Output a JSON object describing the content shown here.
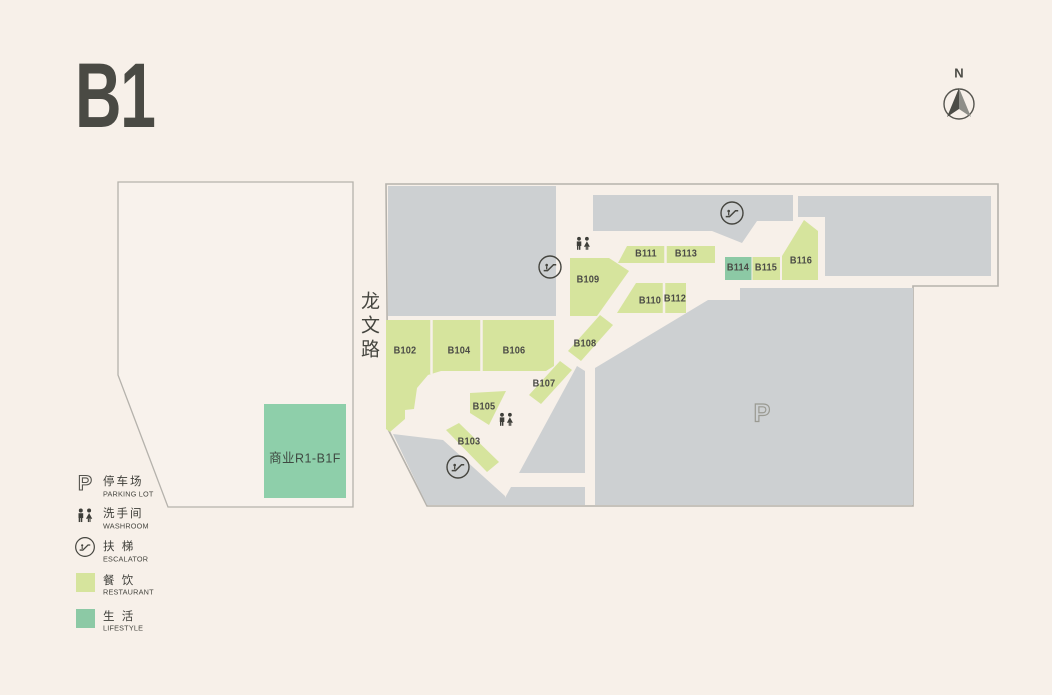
{
  "title": "B1",
  "compass": {
    "label": "N"
  },
  "road": {
    "name": "龙文路"
  },
  "building": {
    "label": "商业R1-B1F",
    "category": "lifestyle"
  },
  "parking": {
    "symbol": "P"
  },
  "units": [
    {
      "label": "B102",
      "category": "restaurant"
    },
    {
      "label": "B103",
      "category": "restaurant"
    },
    {
      "label": "B104",
      "category": "restaurant"
    },
    {
      "label": "B105",
      "category": "restaurant"
    },
    {
      "label": "B106",
      "category": "restaurant"
    },
    {
      "label": "B107",
      "category": "restaurant"
    },
    {
      "label": "B108",
      "category": "restaurant"
    },
    {
      "label": "B109",
      "category": "restaurant"
    },
    {
      "label": "B110",
      "category": "restaurant"
    },
    {
      "label": "B111",
      "category": "restaurant"
    },
    {
      "label": "B112",
      "category": "restaurant"
    },
    {
      "label": "B113",
      "category": "restaurant"
    },
    {
      "label": "B114",
      "category": "lifestyle"
    },
    {
      "label": "B115",
      "category": "restaurant"
    },
    {
      "label": "B116",
      "category": "restaurant"
    }
  ],
  "legend": {
    "parking_icon": "P",
    "items": [
      {
        "cn": "停车场",
        "en": "PARKING LOT",
        "type": "parking"
      },
      {
        "cn": "洗手间",
        "en": "WASHROOM",
        "type": "washroom"
      },
      {
        "cn": "扶 梯",
        "en": "ESCALATOR",
        "type": "escalator"
      },
      {
        "cn": "餐 饮",
        "en": "RESTAURANT",
        "type": "restaurant"
      },
      {
        "cn": "生 活",
        "en": "LIFESTYLE",
        "type": "lifestyle"
      }
    ]
  },
  "colors": {
    "background": "#f7f0e9",
    "parking_gray": "#cdd0d2",
    "restaurant_green": "#d6e49d",
    "lifestyle_teal": "#8cc9a5",
    "outline": "#b5b2ac",
    "text": "#4b4b46"
  }
}
